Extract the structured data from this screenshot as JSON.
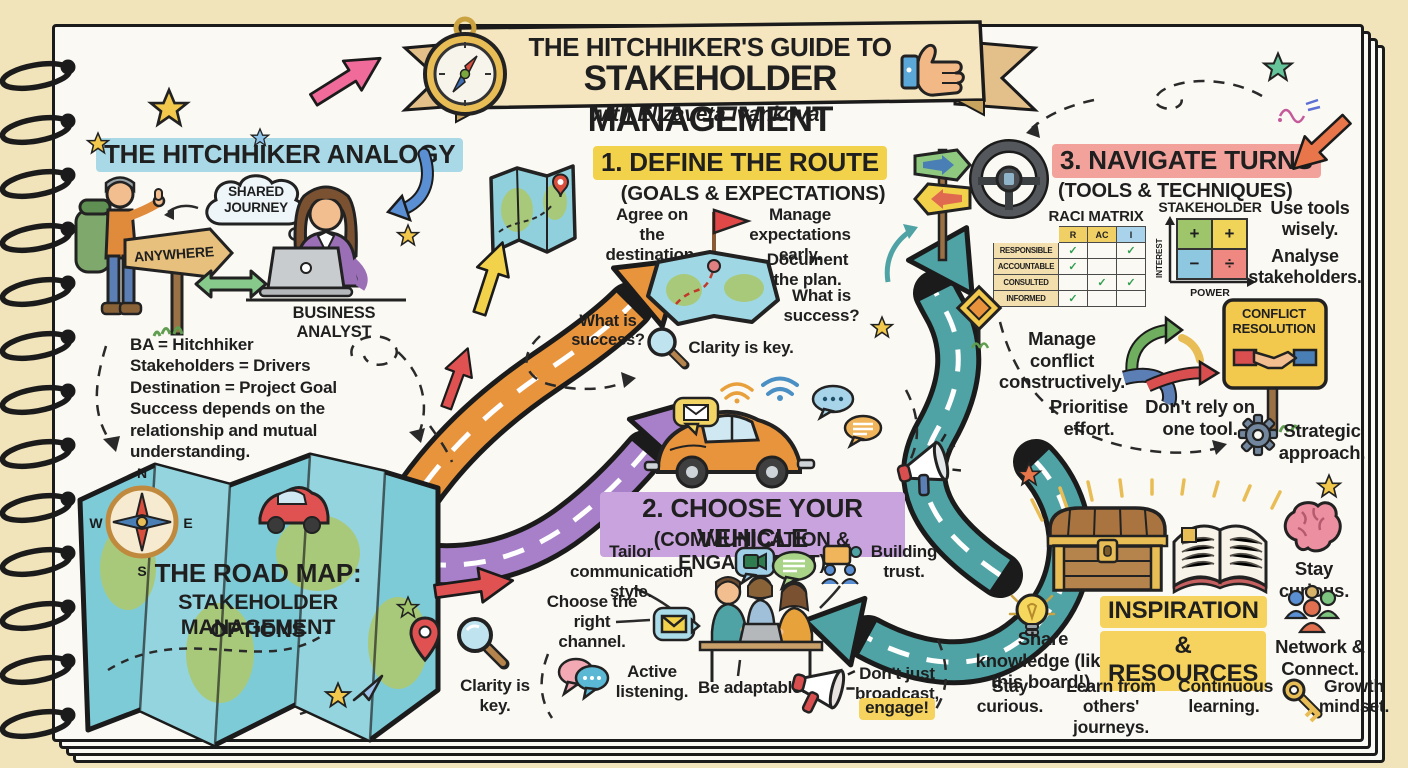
{
  "banner": {
    "title_line1": "THE HITCHHIKER'S GUIDE TO",
    "title_line2": "STAKEHOLDER MANAGEMENT",
    "subtitle": "with Elizaveta Ivankova"
  },
  "analogy": {
    "heading": "THE HITCHHIKER ANALOGY",
    "cloud_line1": "SHARED",
    "cloud_line2": "JOURNEY",
    "sign_label": "ANYWHERE",
    "analyst_label": "BUSINESS ANALYST",
    "notes": [
      "BA = Hitchhiker",
      "Stakeholders = Drivers",
      "Destination = Project Goal",
      "Success depends on the relationship and mutual understanding."
    ]
  },
  "roadmap": {
    "title_line1": "THE ROAD MAP:",
    "title_line2": "STAKEHOLDER MANAGEMENT",
    "title_line3": "OPTIONS",
    "compass": {
      "n": "N",
      "e": "E",
      "s": "S",
      "w": "W"
    }
  },
  "step1": {
    "heading": "1. DEFINE THE ROUTE",
    "subheading": "(GOALS & EXPECTATIONS)",
    "agree": "Agree on the destination.",
    "manage": "Manage expectations early.",
    "document": "Document the plan.",
    "success_a": "What is success?",
    "success_b": "What is success?",
    "clarity": "Clarity is key."
  },
  "step2": {
    "heading": "2. CHOOSE YOUR VEHICLE",
    "subheading": "(COMMUNICATION & ENGAGEMENT)",
    "tailor": "Tailor communication style.",
    "choose": "Choose the right channel.",
    "active": "Active listening.",
    "adaptable": "Be adaptable.",
    "trust": "Building trust.",
    "broadcast": "Don't just broadcast,",
    "engage": "engage!"
  },
  "step3": {
    "heading": "3. NAVIGATE TURNS",
    "subheading": "(TOOLS & TECHNIQUES)",
    "raci": {
      "title": "RACI MATRIX",
      "headers": [
        "R",
        "AC",
        "I"
      ],
      "rows": [
        {
          "label": "RESPONSIBLE",
          "cells": [
            "✓",
            "",
            "✓"
          ]
        },
        {
          "label": "ACCOUNTABLE",
          "cells": [
            "✓",
            "",
            ""
          ]
        },
        {
          "label": "CONSULTED",
          "cells": [
            "",
            "✓",
            "✓"
          ]
        },
        {
          "label": "INFORMED",
          "cells": [
            "✓",
            "",
            ""
          ]
        }
      ]
    },
    "grid": {
      "title": "STAKEHOLDER GRID",
      "y_axis": "INTEREST",
      "x_axis": "POWER",
      "quadrants": [
        "+",
        "+",
        "−",
        "÷"
      ]
    },
    "use_tools": "Use tools wisely.",
    "analyse": "Analyse stakeholders.",
    "manage_conflict": "Manage conflict constructively.",
    "prioritise": "Prioritise effort.",
    "dont_rely": "Don't rely on one tool.",
    "sign_line1": "CONFLICT",
    "sign_line2": "RESOLUTION",
    "strategic": "Strategic approach."
  },
  "inspiration": {
    "heading_line1": "INSPIRATION",
    "heading_line2": "& RESOURCES",
    "share": "Share knowledge (like this board!).",
    "stay_curious_right": "Stay curious.",
    "network": "Network & Connect.",
    "stay_curious_bottom": "Stay curious.",
    "learn": "Learn from others' journeys.",
    "continuous": "Continuous learning.",
    "growth": "Growth mindset."
  },
  "colors": {
    "paper": "#fbf9f4",
    "background": "#f1e3ba",
    "highlight_blue": "#a9d9e6",
    "highlight_yellow": "#f2d24b",
    "highlight_purple": "#c9a3dd",
    "highlight_pink": "#f2a29b",
    "road_orange": "#e8943c",
    "road_purple": "#a87fc9",
    "road_teal": "#4fa3a5"
  }
}
